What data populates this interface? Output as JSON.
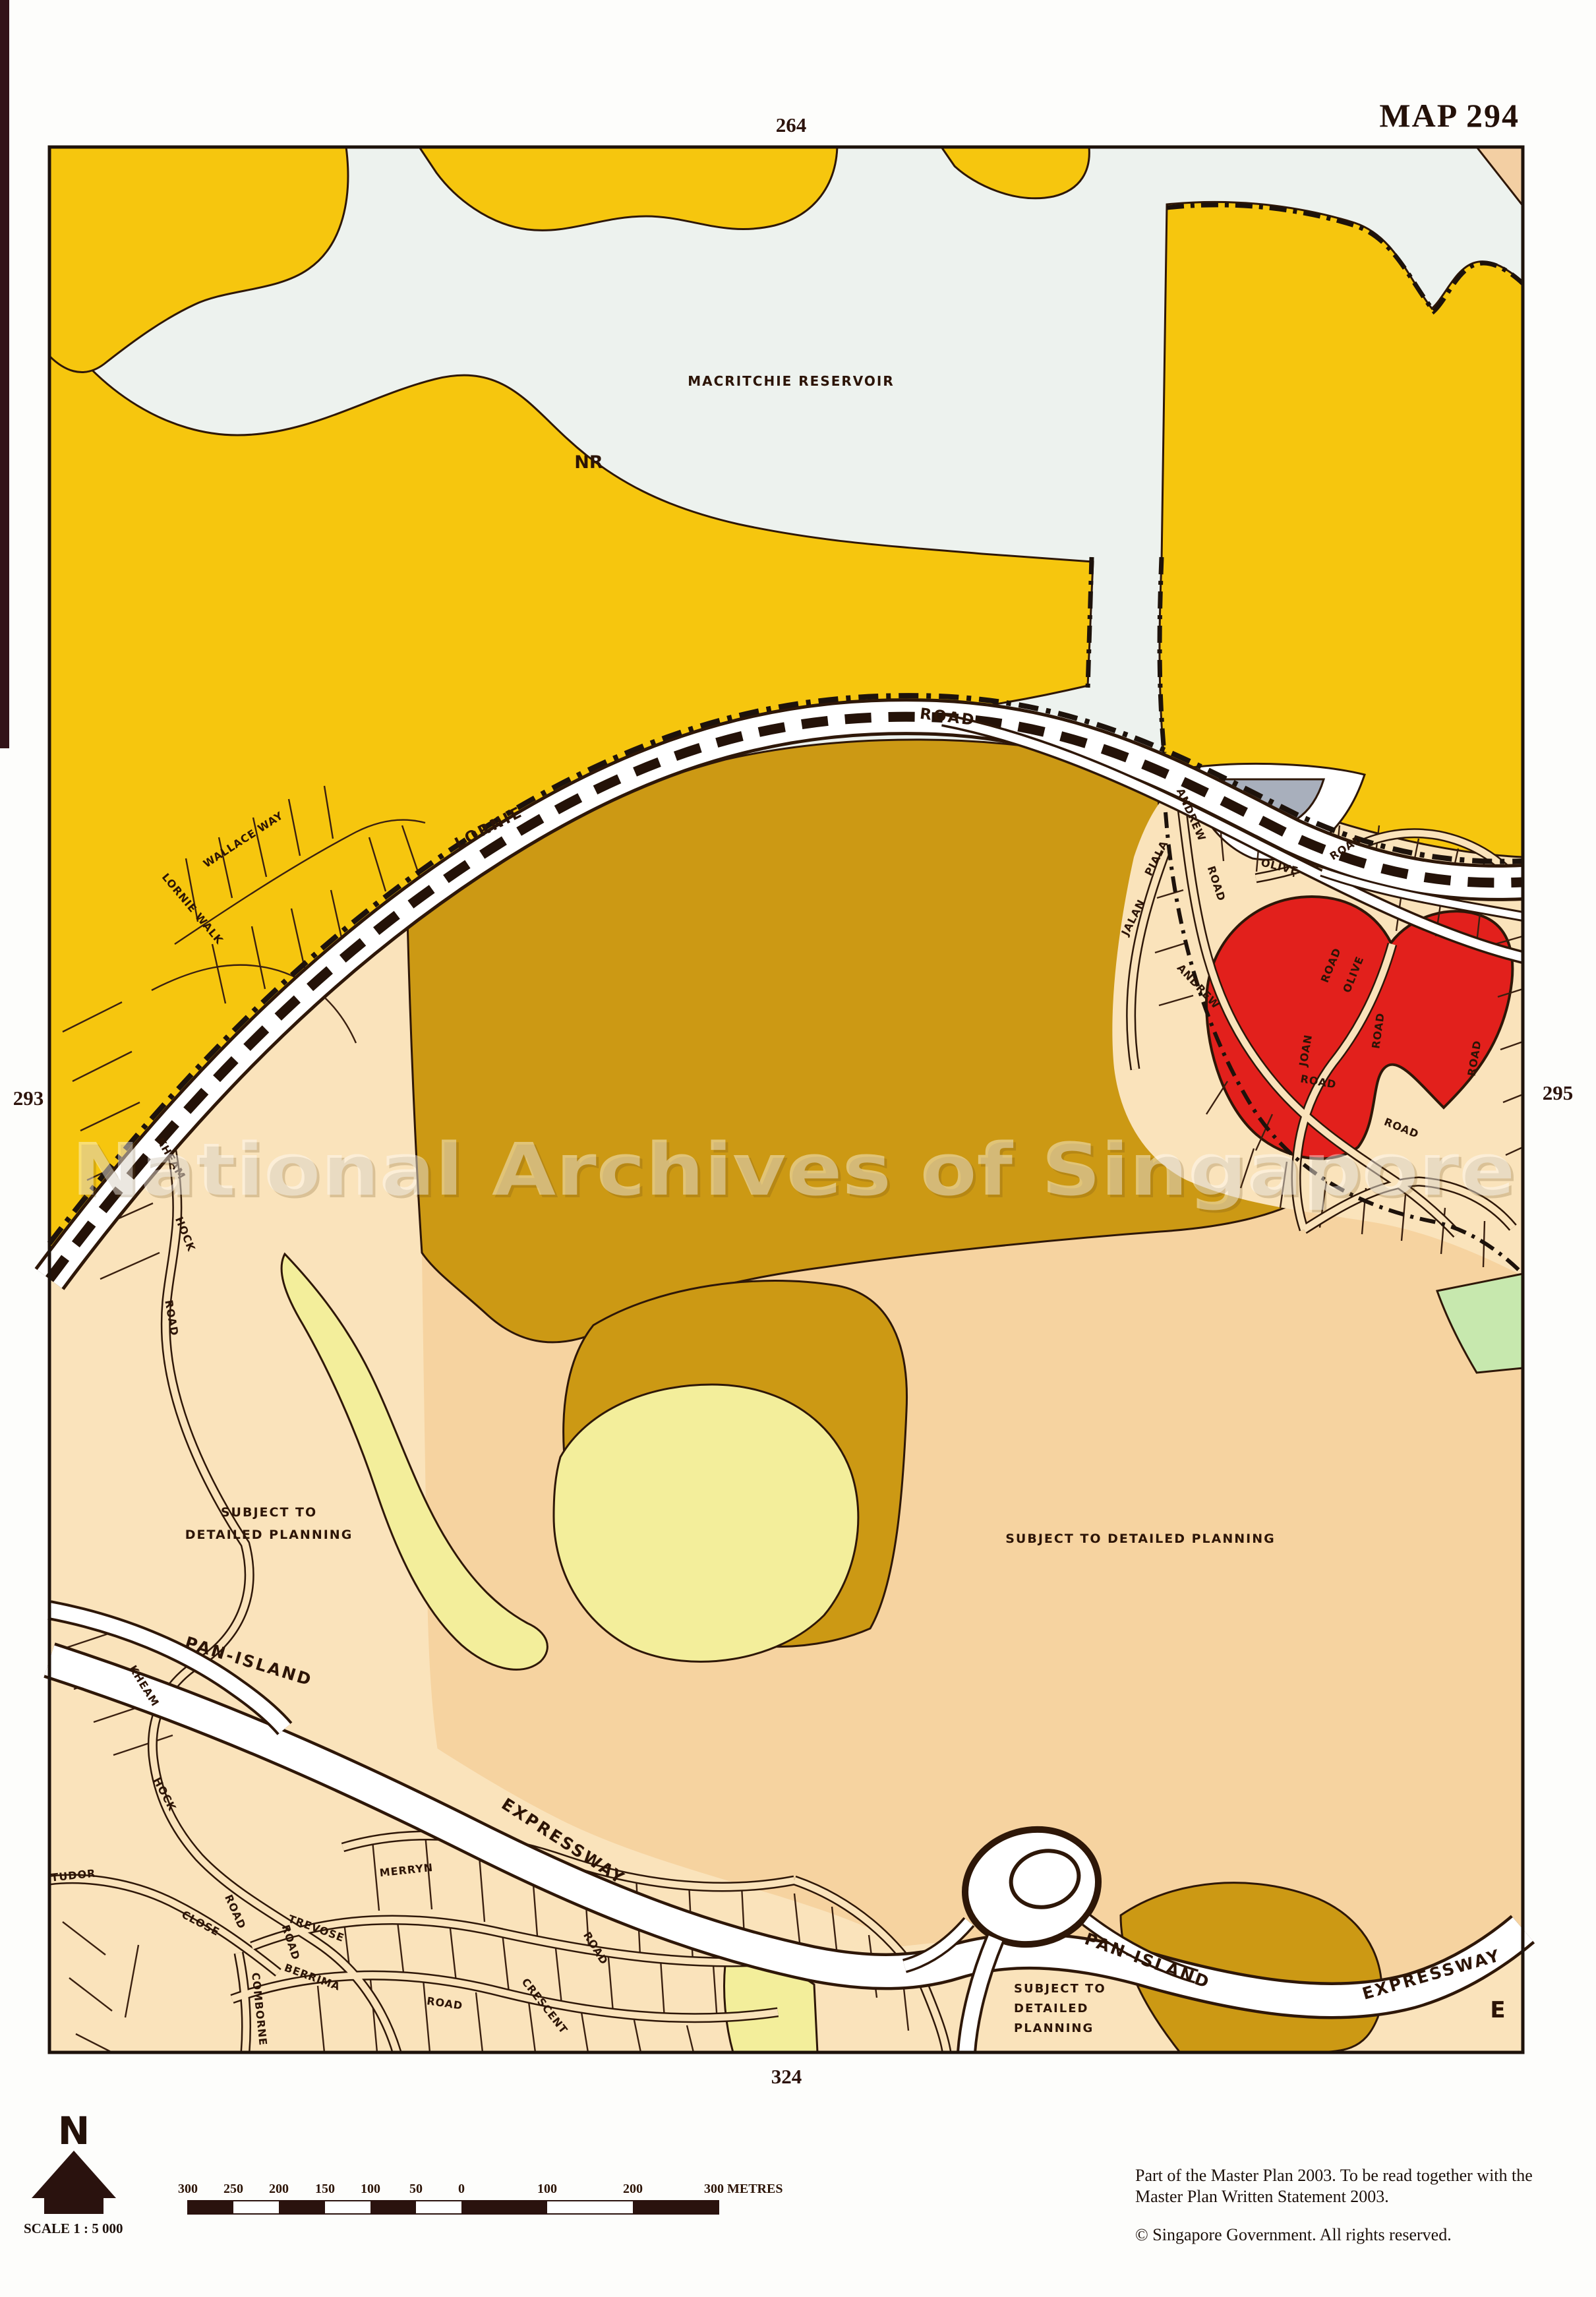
{
  "page": {
    "map_title": "MAP 294",
    "watermark": "National Archives of Singapore",
    "note_line1": "Part of the Master Plan 2003.  To be read together  with  the",
    "note_line2": "Master Plan Written Statement 2003.",
    "copyright": "©  Singapore Government.  All rights reserved."
  },
  "grid_refs": {
    "top": "264",
    "bottom": "324",
    "left": "293",
    "right": "295"
  },
  "compass": {
    "north_letter": "N",
    "scale_label": "SCALE 1 : 5 000"
  },
  "scale_bar": {
    "ticks": [
      "300",
      "250",
      "200",
      "150",
      "100",
      "50",
      "0",
      "100",
      "200"
    ],
    "end_label": "300 METRES"
  },
  "areas": {
    "reservoir": "MACRITCHIE RESERVOIR",
    "nature_reserve": "NR",
    "planning_left_1": "SUBJECT TO",
    "planning_left_2": "DETAILED PLANNING",
    "planning_right": "SUBJECT TO DETAILED PLANNING",
    "planning_bottom_1": "SUBJECT TO",
    "planning_bottom_2": "DETAILED",
    "planning_bottom_3": "PLANNING",
    "section_letter": "E"
  },
  "roads": {
    "lornie": "LORNIE",
    "lornie_road": "ROAD",
    "pie_w_1": "PAN-ISLAND",
    "pie_w_2": "EXPRESSWAY",
    "pie_e_1": "PAN-ISLAND",
    "pie_e_2": "EXPRESSWAY"
  },
  "streets": {
    "wallace_way": "WALLACE WAY",
    "lornie_walk": "LORNIE WALK",
    "andrew_1": "ANDREW",
    "andrew_1_road": "ROAD",
    "jalan": "JALAN",
    "piala": "PIALA",
    "olive_1": "OLIVE",
    "olive_1_road": "ROAD",
    "olive_2": "OLIVE",
    "olive_2_road": "ROAD",
    "olive_e_road": "ROAD",
    "joan": "JOAN",
    "joan_road": "ROAD",
    "andrew_2": "ANDREW",
    "andrew_2_road": "ROAD",
    "andrew_2_road_b": "ROAD",
    "kheam_1": "KHEAM",
    "hock_1": "HOCK",
    "road_1": "ROAD",
    "kheam_2": "KHEAM",
    "hock_2": "HOCK",
    "road_2": "ROAD",
    "tudor": "TUDOR",
    "tudor_close": "CLOSE",
    "merryn": "MERRYN",
    "trevose": "TREVOSE",
    "trevose_road": "ROAD",
    "berrima": "BERRIMA",
    "berrima_road": "ROAD",
    "comborne": "COMBORNE",
    "crescent": "CRESCENT",
    "crescent_road": "ROAD"
  },
  "colors": {
    "nature_reserve_yellow": "#f6c60e",
    "reservoir_pale": "#edf2ee",
    "agriculture_ochre": "#cc9914",
    "residential_cream": "#fae3bb",
    "planning_peach": "#f6d3a0",
    "pale_yellow": "#f3ee9b",
    "red_site": "#e2201c",
    "gray_site": "#a8afbc",
    "green_open": "#c7e8ae",
    "line_dark": "#2e1708"
  }
}
